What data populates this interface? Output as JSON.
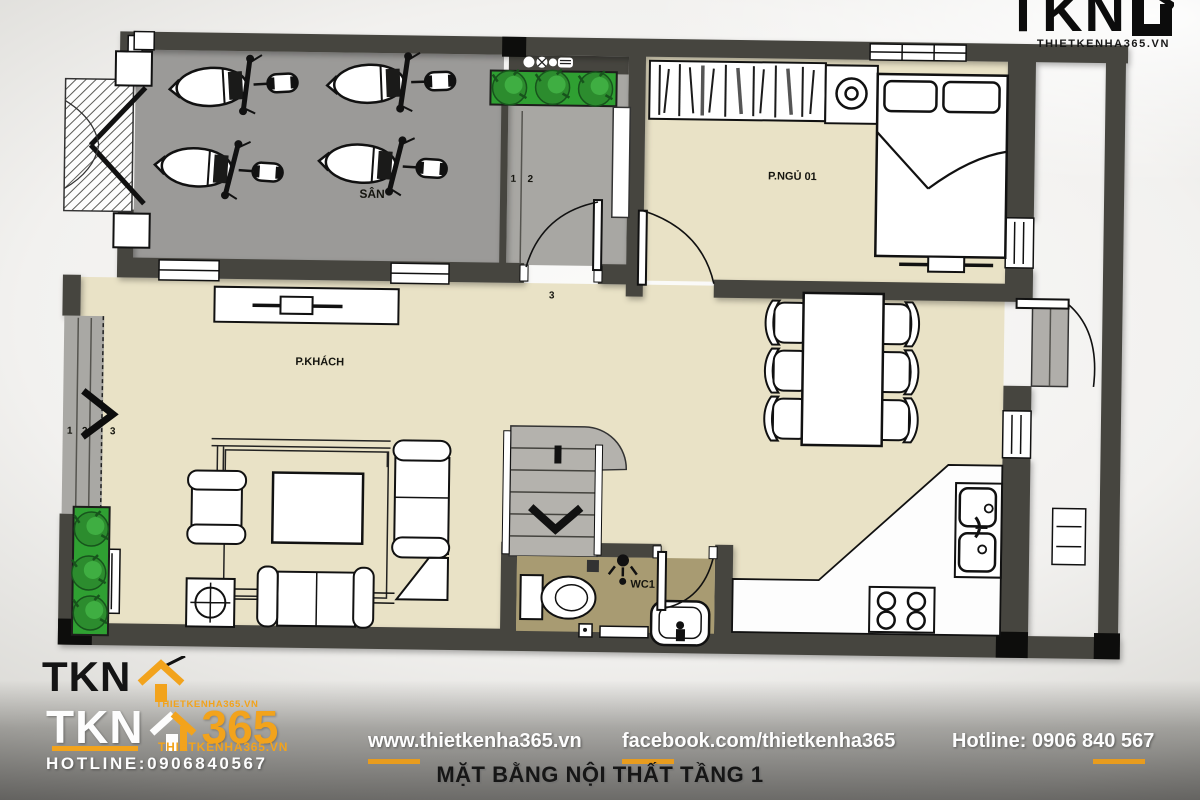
{
  "header_logo": {
    "brand": "TKN",
    "site": "THIETKENHA365.VN"
  },
  "footer_logo": {
    "brand_black": "TKN",
    "brand_white": "TKN",
    "brand_365": "365",
    "site_small": "THIETKENHA365.VN",
    "site": "THIETKENHA365.VN",
    "hotline": "HOTLINE:0906840567"
  },
  "footer_bar": {
    "website": "www.thietkenha365.vn",
    "facebook": "facebook.com/thietkenha365",
    "hotline": "Hotline: 0906 840 567",
    "title": "MẶT BẰNG NỘI THẤT TẦNG 1"
  },
  "plan": {
    "rooms": {
      "yard": "SÂN",
      "bedroom": "P.NGỦ 01",
      "living": "P.KHÁCH",
      "wc": "WC1"
    },
    "vestibule_steps": [
      "1",
      "2",
      "3"
    ],
    "left_entry_steps": [
      "1",
      "2",
      "3"
    ]
  },
  "colors": {
    "accent_orange": "#F2A31C",
    "wall_dark": "#46453f",
    "floor_beige": "#e9e2c6",
    "yard_gray": "#9b9a98",
    "wc_khaki": "#a89b72",
    "stair_gray": "#b4b2ad",
    "plant_green": "#2fa032"
  }
}
